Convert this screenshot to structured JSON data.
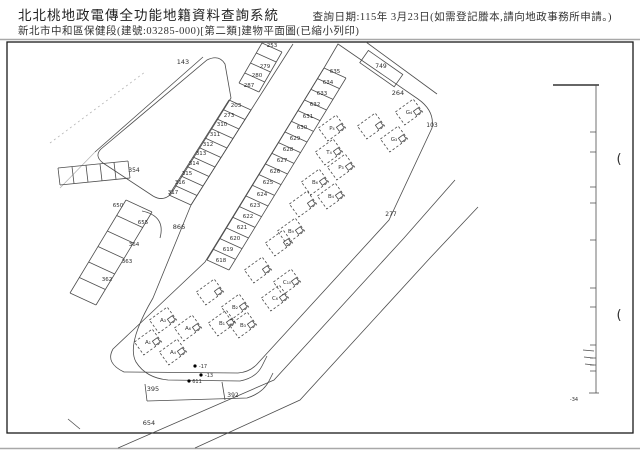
{
  "header": {
    "title": "北北桃地政電傳全功能地籍資料查詢系統",
    "subtitle": "新北市中和區保健段(建號:03285-000)[第二類]建物平面圖(已縮小列印)",
    "query_date": "查詢日期:115年 3月23日(如需登記謄本,請向地政事務所申請。)"
  },
  "colors": {
    "frame": "#1a1a1a",
    "map_line": "#4d4d4d",
    "rule": "#a8a8a8",
    "text": "#2f2f2f"
  },
  "plan": {
    "labels": [
      {
        "t": "143",
        "x": 183,
        "y": 64,
        "fs": 6.5
      },
      {
        "t": "253",
        "x": 272,
        "y": 47
      },
      {
        "t": "279",
        "x": 265,
        "y": 68
      },
      {
        "t": "280",
        "x": 257,
        "y": 77
      },
      {
        "t": "287",
        "x": 249,
        "y": 87
      },
      {
        "t": "203",
        "x": 236,
        "y": 107
      },
      {
        "t": "273",
        "x": 229,
        "y": 117
      },
      {
        "t": "310",
        "x": 222,
        "y": 126
      },
      {
        "t": "311",
        "x": 215,
        "y": 136
      },
      {
        "t": "312",
        "x": 208,
        "y": 146
      },
      {
        "t": "313",
        "x": 201,
        "y": 155
      },
      {
        "t": "314",
        "x": 194,
        "y": 165
      },
      {
        "t": "315",
        "x": 187,
        "y": 175
      },
      {
        "t": "316",
        "x": 180,
        "y": 184
      },
      {
        "t": "317",
        "x": 173,
        "y": 194
      },
      {
        "t": "635",
        "x": 335,
        "y": 73
      },
      {
        "t": "634",
        "x": 328,
        "y": 84
      },
      {
        "t": "633",
        "x": 322,
        "y": 95
      },
      {
        "t": "632",
        "x": 315,
        "y": 106
      },
      {
        "t": "631",
        "x": 308,
        "y": 118
      },
      {
        "t": "630",
        "x": 302,
        "y": 129
      },
      {
        "t": "629",
        "x": 295,
        "y": 140
      },
      {
        "t": "628",
        "x": 288,
        "y": 151
      },
      {
        "t": "627",
        "x": 282,
        "y": 162
      },
      {
        "t": "626",
        "x": 275,
        "y": 173
      },
      {
        "t": "625",
        "x": 268,
        "y": 184
      },
      {
        "t": "624",
        "x": 262,
        "y": 196
      },
      {
        "t": "623",
        "x": 255,
        "y": 207
      },
      {
        "t": "622",
        "x": 248,
        "y": 218
      },
      {
        "t": "621",
        "x": 242,
        "y": 229
      },
      {
        "t": "620",
        "x": 235,
        "y": 240
      },
      {
        "t": "619",
        "x": 228,
        "y": 251
      },
      {
        "t": "618",
        "x": 221,
        "y": 262
      },
      {
        "t": "354",
        "x": 134,
        "y": 172,
        "fs": 6
      },
      {
        "t": "650",
        "x": 118,
        "y": 207
      },
      {
        "t": "655",
        "x": 143,
        "y": 224
      },
      {
        "t": "364",
        "x": 134,
        "y": 246
      },
      {
        "t": "363",
        "x": 127,
        "y": 263
      },
      {
        "t": "362",
        "x": 107,
        "y": 281
      },
      {
        "t": "749",
        "x": 381,
        "y": 68,
        "fs": 6
      },
      {
        "t": "264",
        "x": 398,
        "y": 95,
        "fs": 6.5
      },
      {
        "t": "103",
        "x": 432,
        "y": 127,
        "fs": 6
      },
      {
        "t": "277",
        "x": 391,
        "y": 216,
        "fs": 6
      },
      {
        "t": "866",
        "x": 179,
        "y": 229,
        "fs": 6.5
      },
      {
        "t": "395",
        "x": 153,
        "y": 391,
        "fs": 6.5
      },
      {
        "t": "392",
        "x": 233,
        "y": 397,
        "fs": 6
      },
      {
        "t": "654",
        "x": 149,
        "y": 425,
        "fs": 6.5
      },
      {
        "t": "-34",
        "x": 574,
        "y": 401,
        "fs": 5,
        "c": "#888"
      },
      {
        "t": "(",
        "x": 619,
        "y": 163,
        "fs": 13,
        "c": "#444"
      },
      {
        "t": "(",
        "x": 619,
        "y": 319,
        "fs": 13,
        "c": "#444"
      }
    ],
    "buildings": [
      {
        "t": "G₄",
        "x": 409,
        "y": 112
      },
      {
        "t": "G₃",
        "x": 394,
        "y": 139
      },
      {
        "t": "",
        "x": 371,
        "y": 126
      },
      {
        "t": "P₄",
        "x": 332,
        "y": 128
      },
      {
        "t": "T₄",
        "x": 329,
        "y": 152
      },
      {
        "t": "P₃",
        "x": 341,
        "y": 167
      },
      {
        "t": "B₆",
        "x": 315,
        "y": 182
      },
      {
        "t": "B₄",
        "x": 331,
        "y": 196
      },
      {
        "t": "",
        "x": 303,
        "y": 204
      },
      {
        "t": "B₉",
        "x": 291,
        "y": 231
      },
      {
        "t": "",
        "x": 279,
        "y": 243
      },
      {
        "t": "C₁₀",
        "x": 287,
        "y": 282
      },
      {
        "t": "C₆",
        "x": 275,
        "y": 298
      },
      {
        "t": "",
        "x": 258,
        "y": 270
      },
      {
        "t": "B₂",
        "x": 235,
        "y": 307
      },
      {
        "t": "B₃",
        "x": 243,
        "y": 325
      },
      {
        "t": "B₁",
        "x": 222,
        "y": 323
      },
      {
        "t": "",
        "x": 210,
        "y": 292
      },
      {
        "t": "A₆",
        "x": 188,
        "y": 328
      },
      {
        "t": "A₃",
        "x": 163,
        "y": 320
      },
      {
        "t": "A₄",
        "x": 173,
        "y": 352
      },
      {
        "t": "A₁",
        "x": 148,
        "y": 342
      }
    ],
    "annotations": [
      {
        "t": "-17",
        "x": 203,
        "y": 368
      },
      {
        "t": "-13",
        "x": 209,
        "y": 377
      },
      {
        "t": "611",
        "x": 197,
        "y": 383
      }
    ]
  }
}
